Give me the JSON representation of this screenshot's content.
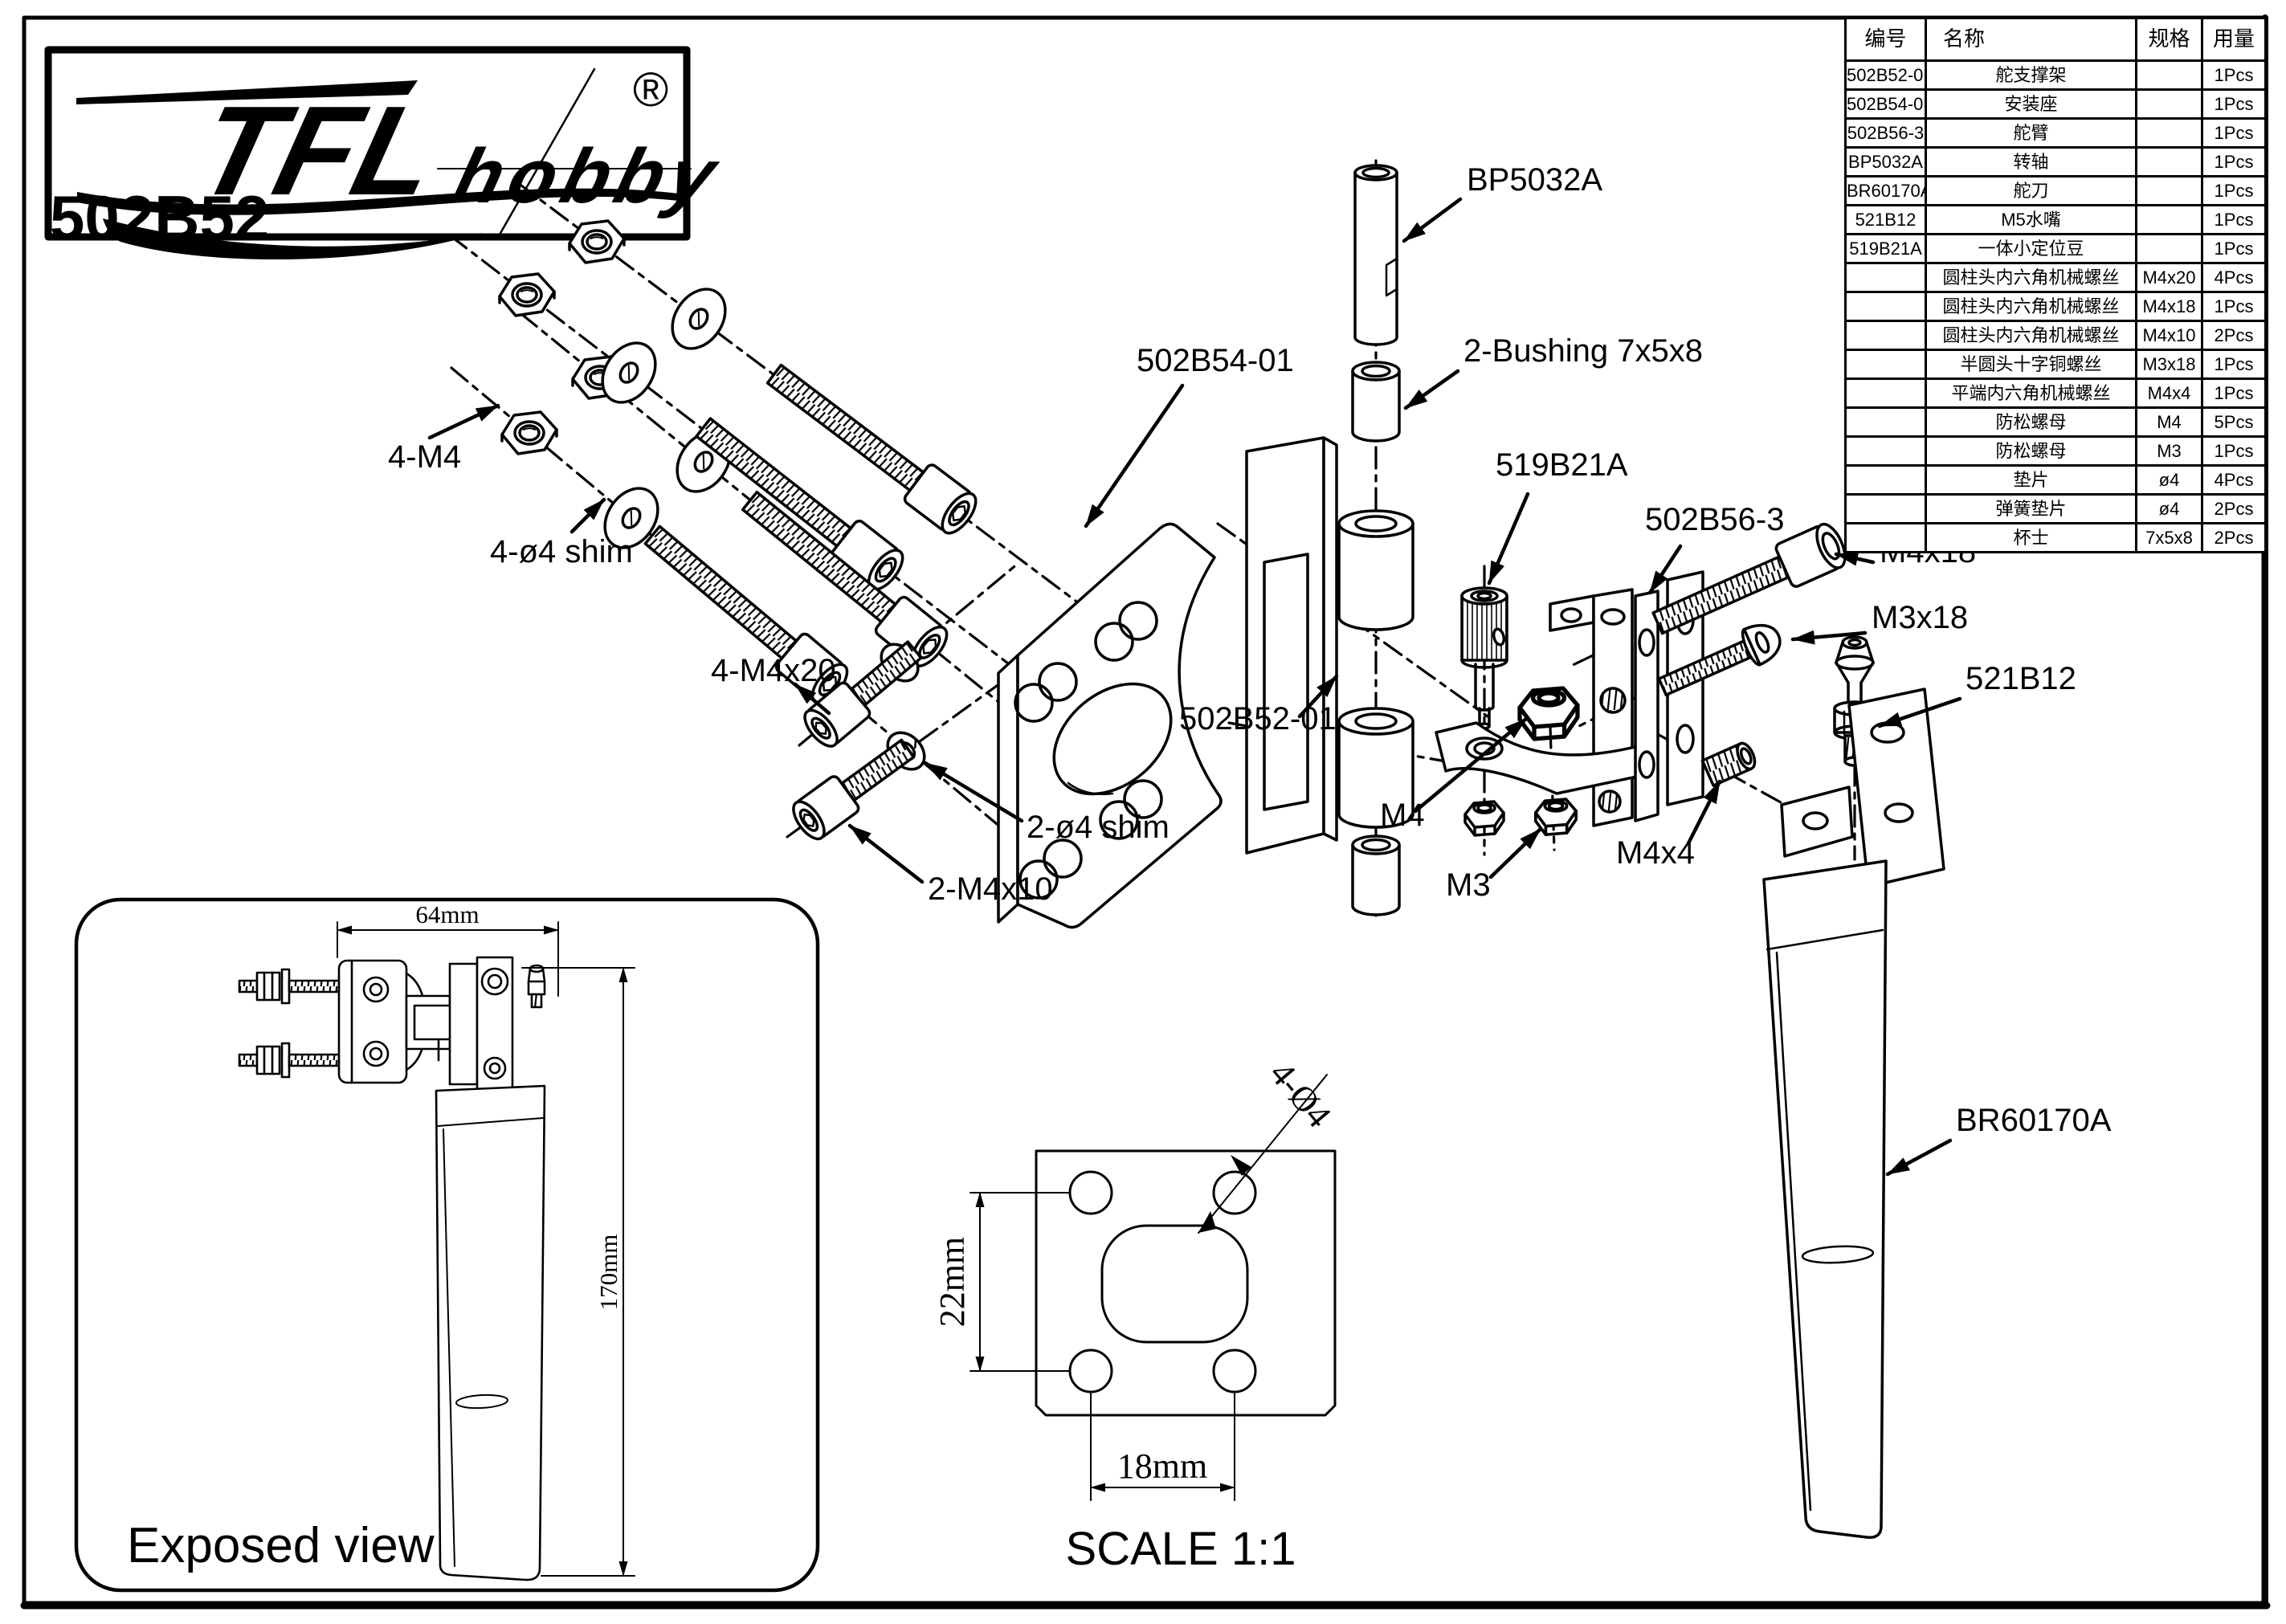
{
  "brand": {
    "tfl": "TFL",
    "hobby": "hobby",
    "registered": "®"
  },
  "part_number": "502B52",
  "parts_table": {
    "headers": {
      "code": "编号",
      "name": "名称",
      "spec": "规格",
      "qty": "用量"
    },
    "rows": [
      {
        "code": "502B52-01",
        "name": "舵支撑架",
        "spec": "",
        "qty": "1Pcs"
      },
      {
        "code": "502B54-01",
        "name": "安装座",
        "spec": "",
        "qty": "1Pcs"
      },
      {
        "code": "502B56-3",
        "name": "舵臂",
        "spec": "",
        "qty": "1Pcs"
      },
      {
        "code": "BP5032A",
        "name": "转轴",
        "spec": "",
        "qty": "1Pcs"
      },
      {
        "code": "BR60170A",
        "name": "舵刀",
        "spec": "",
        "qty": "1Pcs"
      },
      {
        "code": "521B12",
        "name": "M5水嘴",
        "spec": "",
        "qty": "1Pcs"
      },
      {
        "code": "519B21A",
        "name": "一体小定位豆",
        "spec": "",
        "qty": "1Pcs"
      },
      {
        "code": "",
        "name": "圆柱头内六角机械螺丝",
        "spec": "M4x20",
        "qty": "4Pcs"
      },
      {
        "code": "",
        "name": "圆柱头内六角机械螺丝",
        "spec": "M4x18",
        "qty": "1Pcs"
      },
      {
        "code": "",
        "name": "圆柱头内六角机械螺丝",
        "spec": "M4x10",
        "qty": "2Pcs"
      },
      {
        "code": "",
        "name": "半圆头十字铜螺丝",
        "spec": "M3x18",
        "qty": "1Pcs"
      },
      {
        "code": "",
        "name": "平端内六角机械螺丝",
        "spec": "M4x4",
        "qty": "1Pcs"
      },
      {
        "code": "",
        "name": "防松螺母",
        "spec": "M4",
        "qty": "5Pcs"
      },
      {
        "code": "",
        "name": "防松螺母",
        "spec": "M3",
        "qty": "1Pcs"
      },
      {
        "code": "",
        "name": "垫片",
        "spec": "ø4",
        "qty": "4Pcs"
      },
      {
        "code": "",
        "name": "弹簧垫片",
        "spec": "ø4",
        "qty": "2Pcs"
      },
      {
        "code": "",
        "name": "杯士",
        "spec": "7x5x8",
        "qty": "2Pcs"
      }
    ]
  },
  "callouts": {
    "m4_nuts": "4-M4",
    "shims4": "4-ø4 shim",
    "m4x20": "4-M4x20",
    "b502b54": "502B54-01",
    "bp5032a": "BP5032A",
    "bushing": "2-Bushing 7x5x8",
    "b519b21a": "519B21A",
    "b502b56": "502B56-3",
    "m4x18": "M4x18",
    "m3x18": "M3x18",
    "b521b12": "521B12",
    "b502b52": "502B52-01",
    "m4": "M4",
    "shims2": "2-ø4 shim",
    "m4x10": "2-M4x10",
    "m3": "M3",
    "m4x4": "M4x4",
    "br60170a": "BR60170A"
  },
  "exposed_view": {
    "title": "Exposed view",
    "width": "64mm",
    "height": "170mm"
  },
  "scale_view": {
    "scale": "SCALE 1:1",
    "height": "22mm",
    "width": "18mm",
    "holes": "4-Ø4"
  }
}
